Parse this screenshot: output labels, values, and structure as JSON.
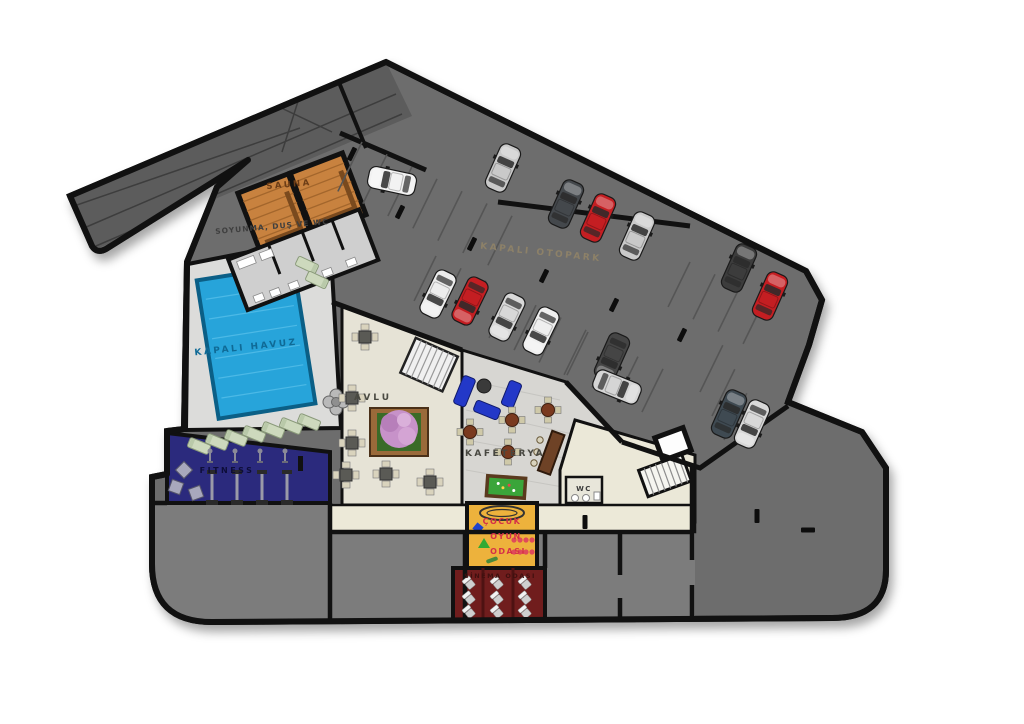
{
  "plan": {
    "type": "architectural-floor-plan",
    "labels": {
      "sauna": "SAUNA",
      "locker": "SOYUNMA, DUŞ VE WC",
      "pool": "KAPALI HAVUZ",
      "fitness": "FITNESS",
      "courtyard": "AVLU",
      "cafeteria": "KAFETERYA",
      "parking": "KAPALI OTOPARK",
      "wc": "WC",
      "kids_line1": "ÇOCUK",
      "kids_line2": "OYUN",
      "kids_line3": "ODASI",
      "cinema": "SİNEMA ODASI"
    },
    "colors": {
      "parking_floor": "#6d6d6d",
      "ramp": "#5c5c5c",
      "wall": "#111111",
      "pool_water": "#27a4da",
      "pool_edge": "#0b5f86",
      "deck": "#dcdcda",
      "sauna_wood": "#c8823f",
      "locker_floor": "#cfcfcf",
      "fitness_floor": "#2b2a7d",
      "courtyard_floor": "#e6e3d6",
      "cafeteria_floor": "#d7d6d2",
      "corridor": "#ece9d8",
      "kids_room": "#edb23c",
      "cinema_room": "#701d1d",
      "storage_rooms": "#7c7c7c",
      "sofa_blue": "#2338c8",
      "billiard_green": "#3aa53a",
      "car_red": "#c41e22",
      "car_silver": "#c9c9c9",
      "car_dark": "#424a50",
      "car_white": "#f2f2f2",
      "lounger_green": "#cdd9bd",
      "tree_pink": "#c792c9"
    },
    "cars": [
      {
        "x": 392,
        "y": 181,
        "r": -78,
        "c": "#f2f2f2"
      },
      {
        "x": 503,
        "y": 168,
        "r": 24,
        "c": "#c9c9c9"
      },
      {
        "x": 566,
        "y": 204,
        "r": 24,
        "c": "#44484c"
      },
      {
        "x": 598,
        "y": 218,
        "r": 24,
        "c": "#c41e22"
      },
      {
        "x": 637,
        "y": 236,
        "r": 24,
        "c": "#c9c9c9"
      },
      {
        "x": 739,
        "y": 268,
        "r": 24,
        "c": "#3c3c3c"
      },
      {
        "x": 770,
        "y": 296,
        "r": 24,
        "c": "#c41e22"
      },
      {
        "x": 438,
        "y": 294,
        "r": 206,
        "c": "#ededed"
      },
      {
        "x": 470,
        "y": 301,
        "r": 206,
        "c": "#c41e22"
      },
      {
        "x": 507,
        "y": 317,
        "r": 206,
        "c": "#d8d8d8"
      },
      {
        "x": 541,
        "y": 331,
        "r": 206,
        "c": "#efefef"
      },
      {
        "x": 612,
        "y": 357,
        "r": 204,
        "c": "#454545"
      },
      {
        "x": 617,
        "y": 387,
        "r": 112,
        "c": "#d5d5d5"
      },
      {
        "x": 729,
        "y": 414,
        "r": 24,
        "c": "#3f4a52"
      },
      {
        "x": 752,
        "y": 424,
        "r": 204,
        "c": "#d8d8d8"
      }
    ],
    "stall_rows": [
      {
        "x": 362,
        "y": 142,
        "n": 7,
        "sx": 25,
        "sy": 12.3,
        "len": 55,
        "ang": 116
      },
      {
        "x": 690,
        "y": 262,
        "n": 4,
        "sx": 25,
        "sy": 12.3,
        "len": 50,
        "ang": 116
      },
      {
        "x": 436,
        "y": 256,
        "n": 7,
        "sx": 25,
        "sy": 12.3,
        "len": 50,
        "ang": 116
      },
      {
        "x": 588,
        "y": 332,
        "n": 4,
        "sx": 25,
        "sy": 12.3,
        "len": 48,
        "ang": 116
      },
      {
        "x": 700,
        "y": 392,
        "n": 3,
        "sx": 12,
        "sy": 24,
        "len": 52,
        "ang": -64
      }
    ],
    "wheel_stops": [
      {
        "x": 352,
        "y": 154,
        "r": 26
      },
      {
        "x": 400,
        "y": 212,
        "r": 26
      },
      {
        "x": 472,
        "y": 244,
        "r": 26
      },
      {
        "x": 544,
        "y": 276,
        "r": 26
      },
      {
        "x": 614,
        "y": 305,
        "r": 26
      },
      {
        "x": 682,
        "y": 335,
        "r": 26
      },
      {
        "x": 585,
        "y": 522,
        "r": 0
      },
      {
        "x": 757,
        "y": 516,
        "r": 0
      },
      {
        "x": 808,
        "y": 530,
        "r": 90
      }
    ],
    "courtyard_tables": [
      {
        "x": 365,
        "y": 337
      },
      {
        "x": 352,
        "y": 398
      },
      {
        "x": 352,
        "y": 443
      },
      {
        "x": 346,
        "y": 475
      },
      {
        "x": 386,
        "y": 474
      },
      {
        "x": 430,
        "y": 482
      }
    ],
    "cafe_tables": [
      {
        "x": 470,
        "y": 432
      },
      {
        "x": 512,
        "y": 420
      },
      {
        "x": 548,
        "y": 410
      },
      {
        "x": 508,
        "y": 452
      }
    ],
    "loungers": [
      {
        "x": 199,
        "y": 446,
        "r": -68
      },
      {
        "x": 217,
        "y": 442,
        "r": -68
      },
      {
        "x": 236,
        "y": 438,
        "r": -68
      },
      {
        "x": 254,
        "y": 434,
        "r": -68
      },
      {
        "x": 273,
        "y": 430,
        "r": -68
      },
      {
        "x": 291,
        "y": 426,
        "r": -68
      },
      {
        "x": 309,
        "y": 422,
        "r": -68
      },
      {
        "x": 307,
        "y": 265,
        "r": 115
      },
      {
        "x": 317,
        "y": 280,
        "r": 115
      }
    ],
    "fitness_racks": [
      {
        "x": 212,
        "y": 488
      },
      {
        "x": 237,
        "y": 488
      },
      {
        "x": 262,
        "y": 488
      },
      {
        "x": 287,
        "y": 488
      }
    ],
    "fitness_machines": [
      {
        "x": 210,
        "y": 456
      },
      {
        "x": 235,
        "y": 456
      },
      {
        "x": 260,
        "y": 456
      },
      {
        "x": 285,
        "y": 456
      }
    ],
    "pinwheels": [
      {
        "x": 184,
        "y": 470,
        "r": 45
      },
      {
        "x": 176,
        "y": 487,
        "r": 20
      },
      {
        "x": 196,
        "y": 493,
        "r": 70
      }
    ],
    "cinema_seats": {
      "cols": [
        469,
        497,
        525
      ],
      "rows": [
        583,
        598,
        612
      ]
    },
    "bar_stools": [
      {
        "x": 540,
        "y": 440
      },
      {
        "x": 537,
        "y": 452
      },
      {
        "x": 534,
        "y": 463
      }
    ]
  }
}
